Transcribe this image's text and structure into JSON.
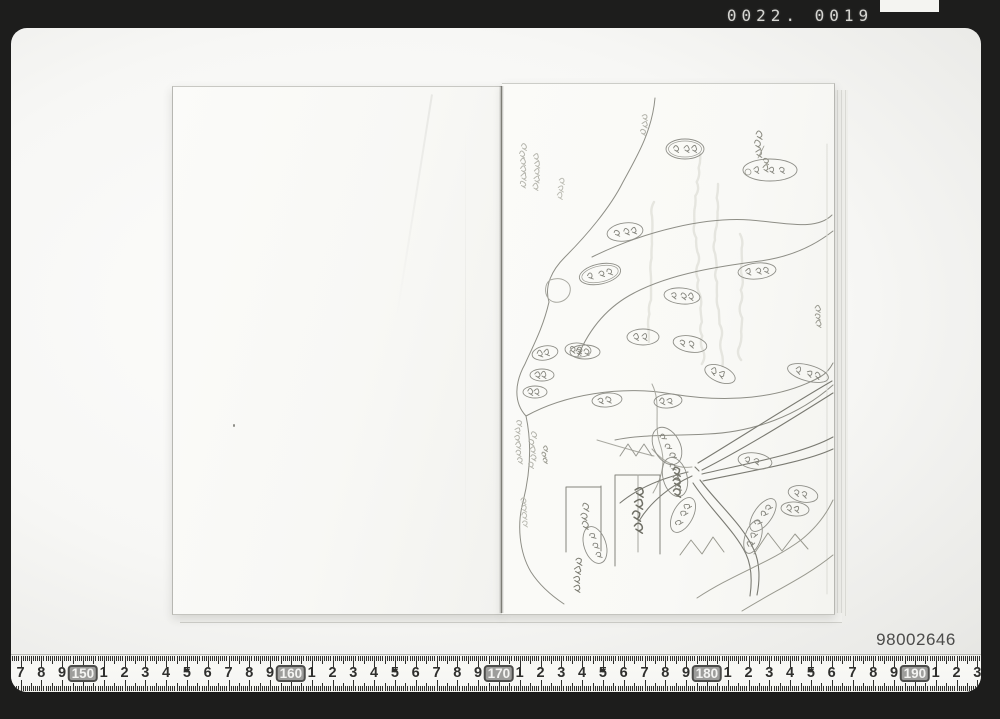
{
  "window": {
    "counter": "0022. 0019"
  },
  "stage": {
    "id_number": "98002646"
  },
  "ruler": {
    "start_value": 147,
    "labels": [
      "7",
      "8",
      "9",
      "150",
      "1",
      "2",
      "3",
      "4",
      "5",
      "6",
      "7",
      "8",
      "9",
      "160",
      "1",
      "2",
      "3",
      "4",
      "5",
      "6",
      "7",
      "8",
      "9",
      "170",
      "1",
      "2",
      "3",
      "4",
      "5",
      "6",
      "7",
      "8",
      "9",
      "180",
      "1",
      "2",
      "3",
      "4",
      "5",
      "6",
      "7",
      "8",
      "9",
      "190",
      "1",
      "2",
      "3"
    ],
    "boxed_values": [
      "150",
      "160",
      "170",
      "180",
      "190"
    ]
  },
  "colors": {
    "frame_black": "#1d1d1c",
    "counter_text": "#d6d6d2",
    "stage_gray": "#d2d2cf",
    "page_white": "#fafaf8",
    "map_ink": "#8e8e86",
    "ruler_tick": "#2f2f2c",
    "id_text": "#4b4b4a"
  }
}
